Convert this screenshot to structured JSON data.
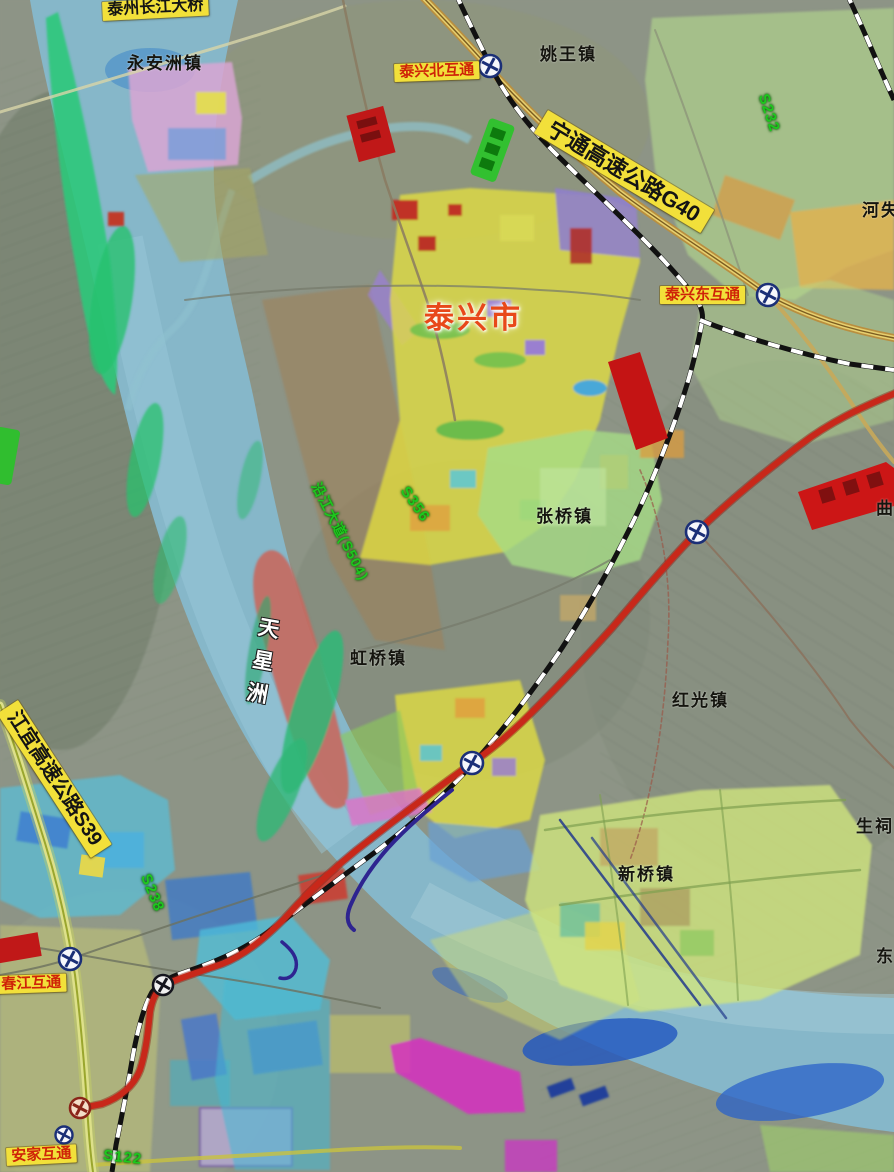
{
  "map": {
    "labels": {
      "bridge": "泰州长江大桥",
      "yonganzhou": "永安洲镇",
      "taixing_north": "泰兴北互通",
      "yaowang": "姚王镇",
      "g40": "宁通高速公路G40",
      "s232": "S232",
      "heshi": "河失",
      "taixing_city": "泰兴市",
      "taixing_east": "泰兴东互通",
      "yanjiang_s504": "沿江大道(S504)",
      "s356": "S356",
      "zhangqiao": "张桥镇",
      "hongqiao": "虹桥镇",
      "hongguang": "红光镇",
      "tianxingzhou": "天星洲",
      "qu": "曲",
      "jiangyi_s39": "江宜高速公路S39",
      "s238": "S238",
      "chunjiang": "春江互通",
      "xinqiao": "新桥镇",
      "shengci": "生祠",
      "dong": "东",
      "anjia": "安家互通",
      "s122": "S122"
    },
    "colors": {
      "label_bg": "#f2e03a",
      "label_red_text": "#cf2408",
      "green_road_text": "#1dc81d",
      "route_red": "#c8281a",
      "expressway_yellow": "#e0c860",
      "railway_black": "#111111",
      "water": "#86b7c9",
      "city_text": "#e8481a"
    },
    "icons": {
      "interchange_symbol": "circle-cross"
    }
  }
}
